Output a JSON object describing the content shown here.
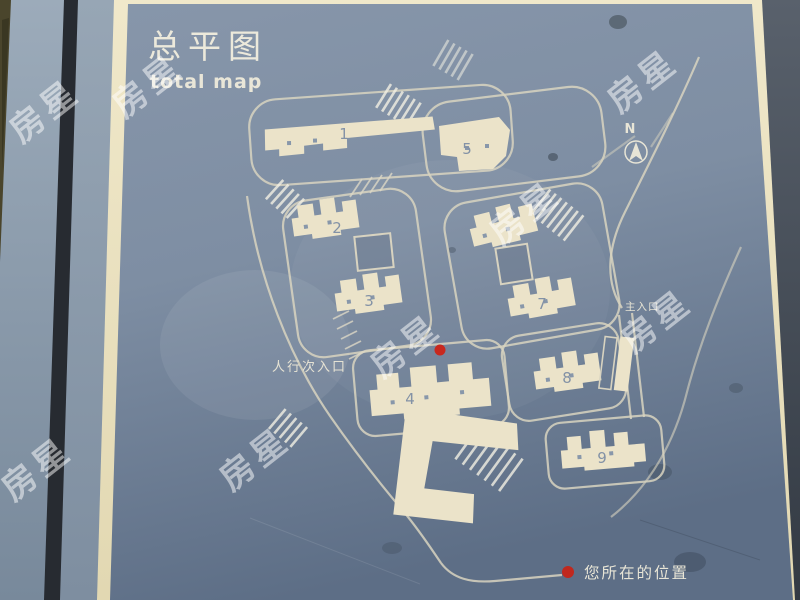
{
  "board": {
    "title_zh": "总平图",
    "title_en": "total map",
    "compass": {
      "label": "N"
    },
    "entrances": {
      "main": "主入口",
      "pedestrian_secondary": "人行次入口"
    },
    "legend": {
      "you_are_here": "您所在的位置"
    },
    "building_labels": {
      "b1": "1",
      "b2": "2",
      "b3": "3",
      "b4": "4",
      "b5": "5",
      "b7": "7",
      "b8": "8",
      "b9": "9"
    },
    "colors": {
      "panel_blue": "#7e8ea3",
      "building_cream": "#ebe3c9",
      "frame_cream": "#ece3c2",
      "marker_red": "#c8281e",
      "road_line": "#d8d3c0"
    }
  },
  "watermark": {
    "text": "房星"
  }
}
